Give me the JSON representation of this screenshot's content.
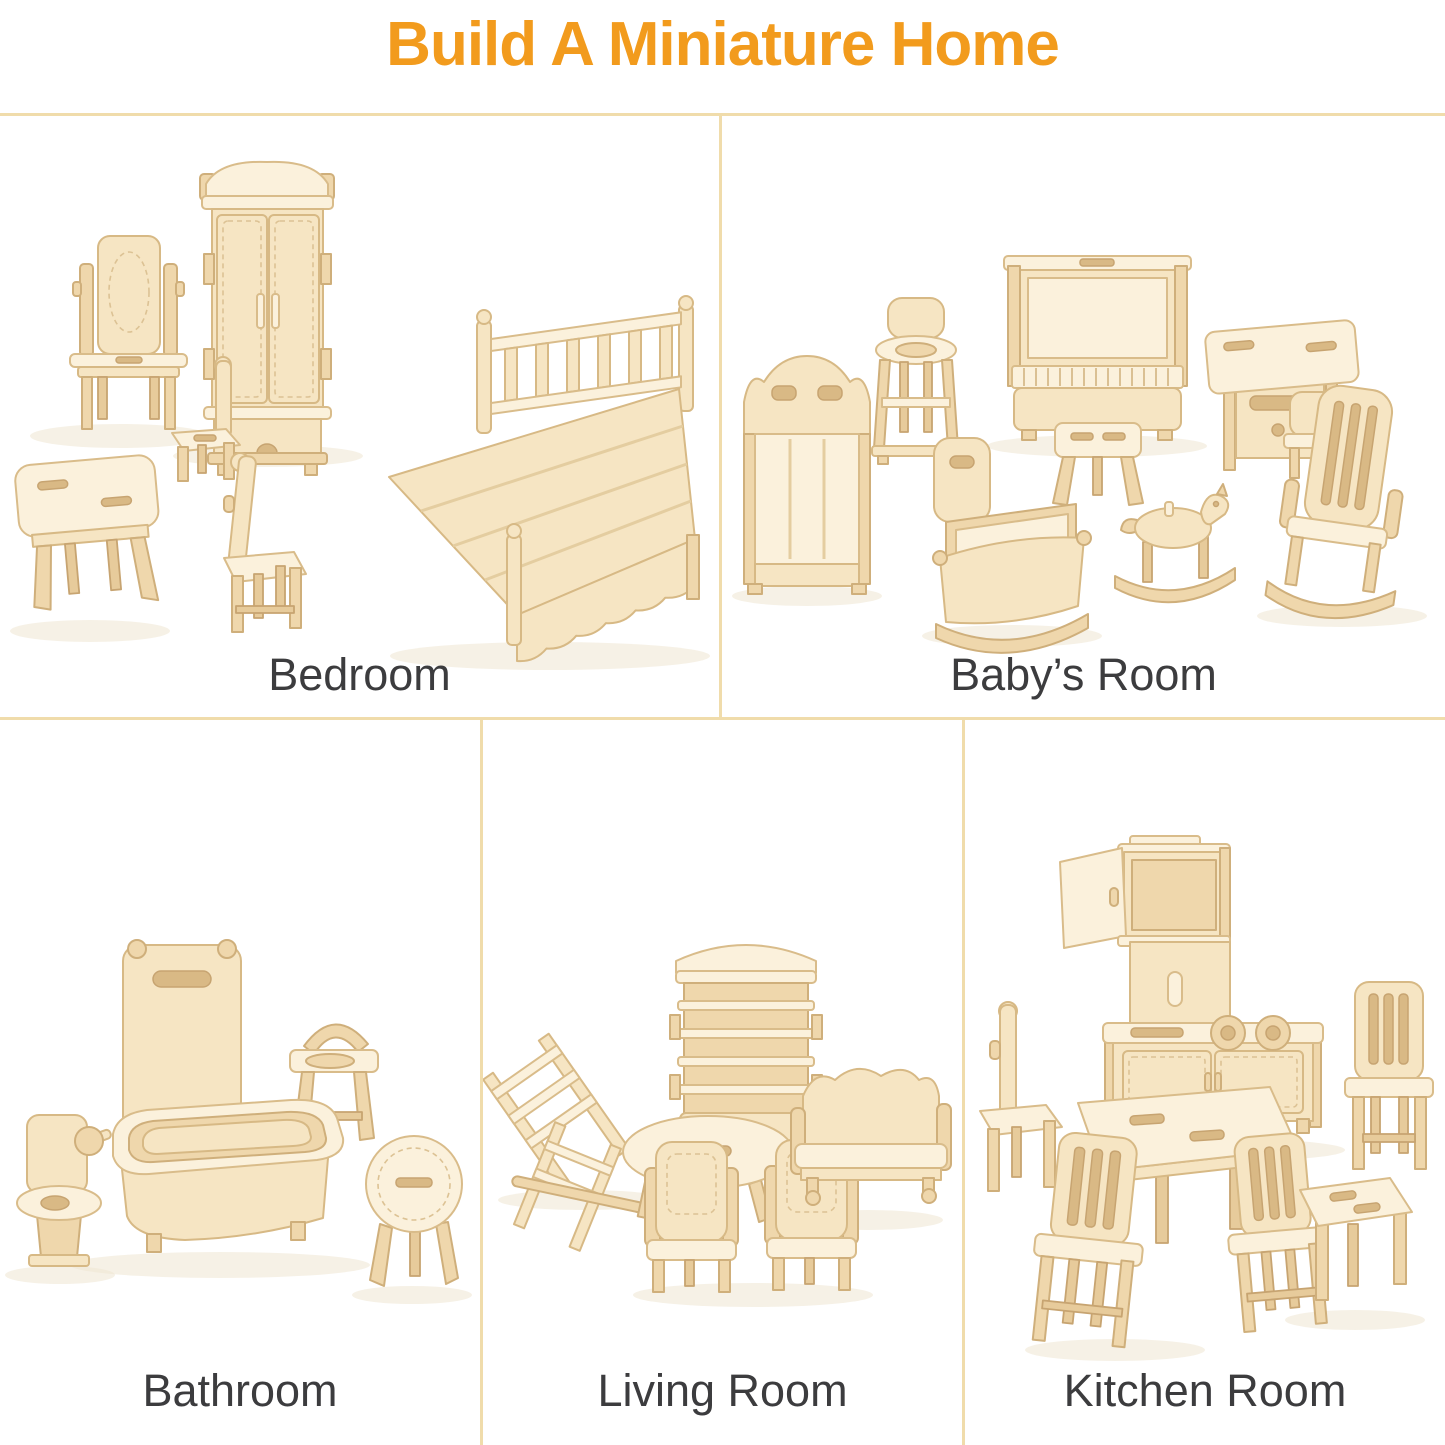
{
  "header": {
    "title": "Build A Miniature Home",
    "color": "#F29B1D"
  },
  "dividers": {
    "color": "#F0DCAB"
  },
  "sections": [
    {
      "id": "bedroom",
      "label": "Bedroom",
      "items": [
        "dressing-table-with-mirror",
        "wardrobe",
        "double-bed",
        "side-table",
        "small-chair",
        "dining-chair"
      ]
    },
    {
      "id": "babys-room",
      "label": "Baby’s Room",
      "items": [
        "crib-bed",
        "high-chair",
        "upright-piano",
        "piano-stool",
        "dresser-desk-with-chair",
        "cradle",
        "rocking-horse",
        "rocking-chair"
      ]
    },
    {
      "id": "bathroom",
      "label": "Bathroom",
      "items": [
        "toilet",
        "shower-panel",
        "bathtub",
        "wash-basin-stand",
        "round-side-table"
      ]
    },
    {
      "id": "living-room",
      "label": "Living Room",
      "items": [
        "lounge-chair",
        "bookshelf-cabinet",
        "oval-coffee-table",
        "armchair",
        "armchair",
        "sofa-bench"
      ]
    },
    {
      "id": "kitchen",
      "label": "Kitchen Room",
      "items": [
        "wall-cabinet",
        "kitchen-counter-with-burners",
        "dining-table",
        "side-chair",
        "kitchen-chair",
        "kitchen-chair",
        "slat-back-chair",
        "stool"
      ]
    }
  ],
  "palette": {
    "wood_light": "#FBF1DC",
    "wood_base": "#F6E5C3",
    "wood_mid": "#EFD7AC",
    "wood_dark": "#E7CB9B",
    "outline": "#D7B985",
    "label_color": "#3C3C3E",
    "background": "#FFFFFF"
  }
}
